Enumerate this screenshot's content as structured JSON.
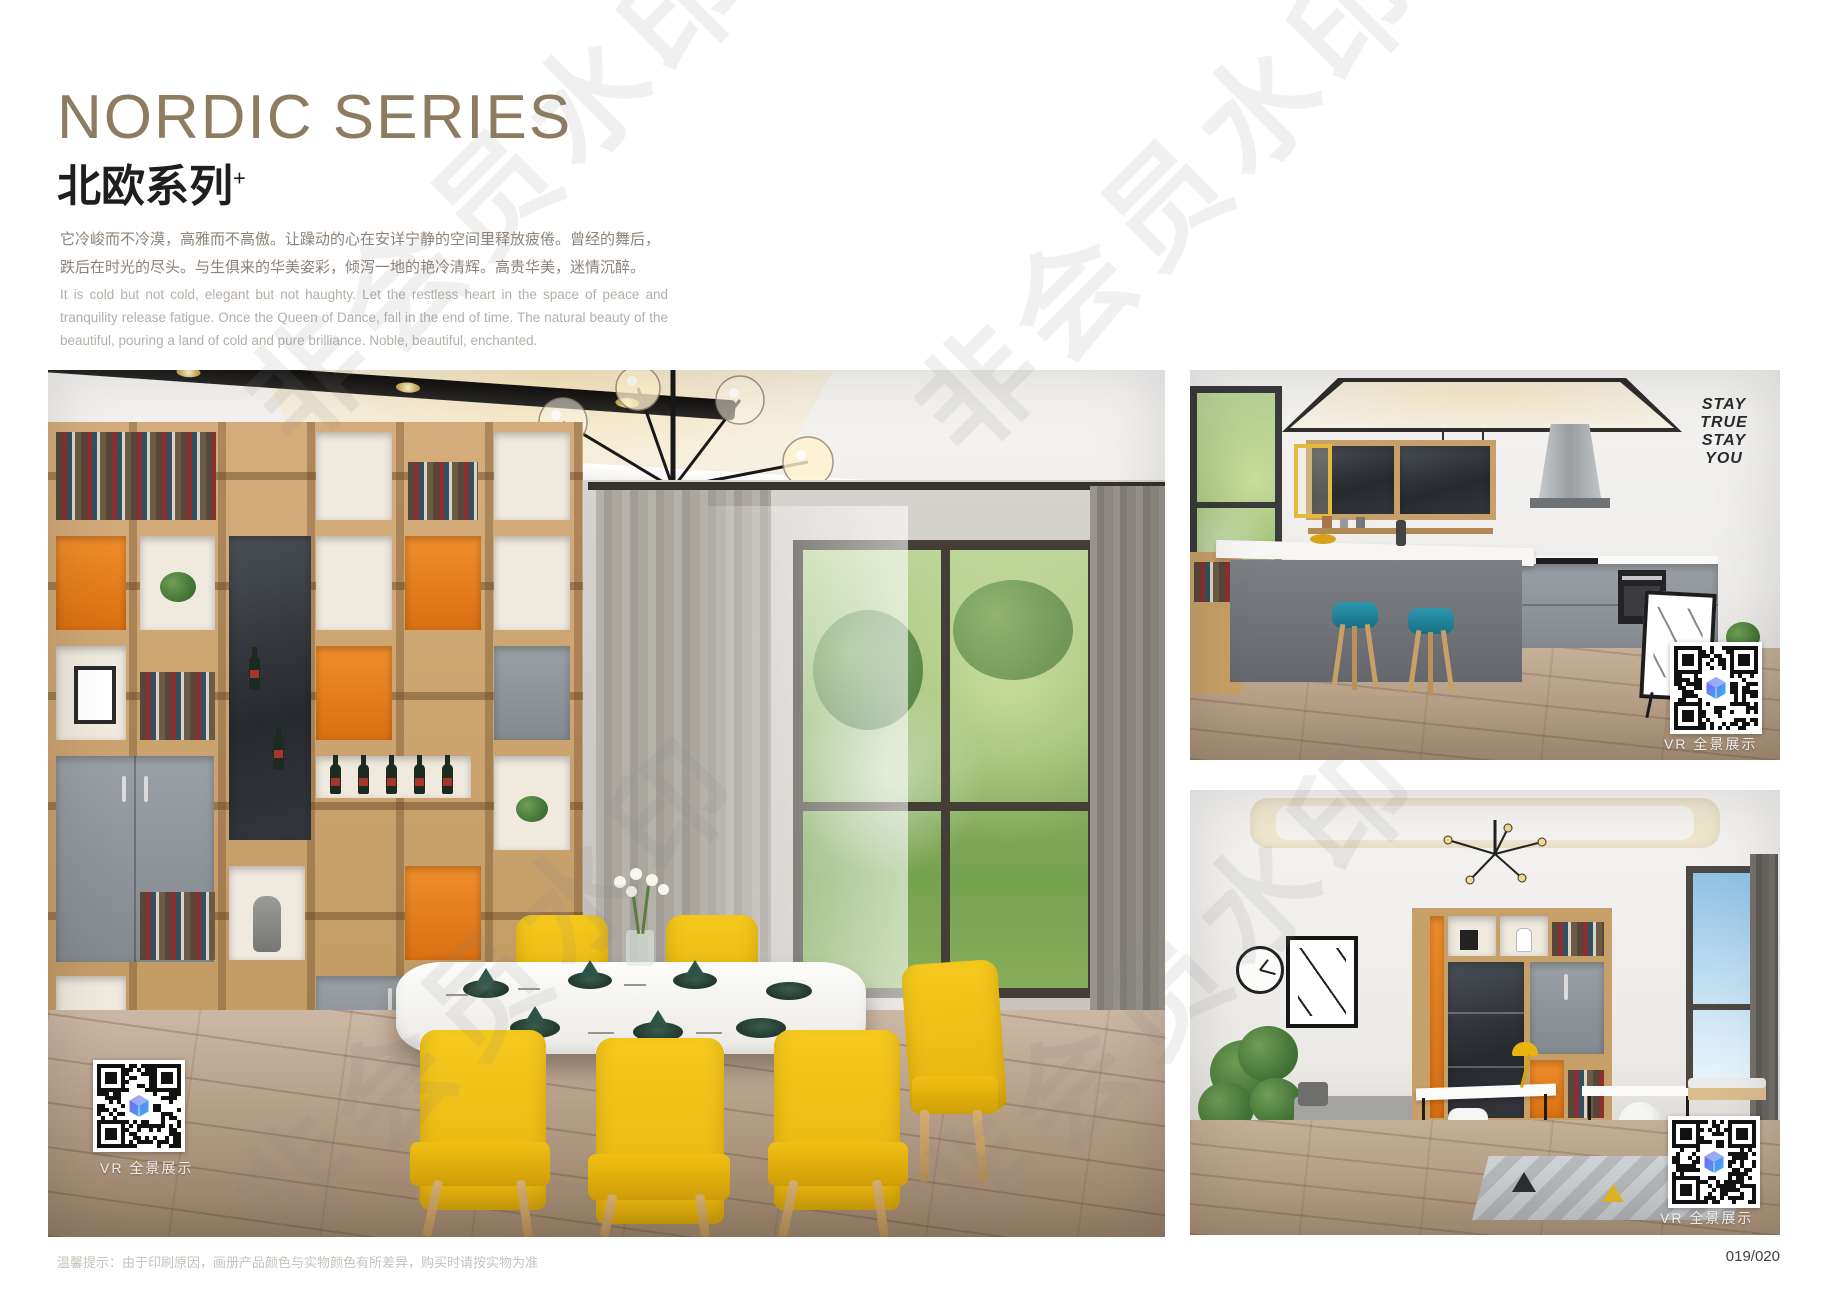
{
  "header": {
    "title_en": "NORDIC SERIES",
    "title_cn": "北欧系列",
    "title_sup": "+",
    "desc_cn": "它冷峻而不冷漠，高雅而不高傲。让躁动的心在安详宁静的空间里释放疲倦。曾经的舞后，跌后在时光的尽头。与生俱来的华美姿彩，倾泻一地的艳冷清辉。高贵华美，迷情沉醉。",
    "desc_en": "It is cold but not cold, elegant but not haughty. Let the restless heart in the space of peace and tranquility release fatigue. Once the Queen of Dance, fall in the end of time. The natural beauty of the beautiful, pouring a land of cold and pure brilliance. Noble, beautiful, enchanted."
  },
  "images": {
    "main": {
      "subject": "dining-room",
      "vr_label": "VR 全景展示"
    },
    "kitchen": {
      "subject": "kitchen-bar",
      "vr_label": "VR 全景展示",
      "decal_lines": [
        "STAY",
        "TRUE",
        "STAY",
        "YOU"
      ]
    },
    "study": {
      "subject": "study-room",
      "vr_label": "VR 全景展示"
    }
  },
  "footer": {
    "note": "温馨提示：由于印刷原因，画册产品颜色与实物颜色有所差异，购买时请按实物为准",
    "page_number": "019/020"
  },
  "watermark": {
    "text": "非会员水印"
  },
  "colors": {
    "title_brown": "#8d7c60",
    "accent_orange": "#e07a1e",
    "chair_yellow": "#f3c41e",
    "stool_teal": "#2286a0",
    "wood": "#c9a06b",
    "qr_logo_gradient": [
      "#7e5ff0",
      "#34b5ef"
    ]
  }
}
